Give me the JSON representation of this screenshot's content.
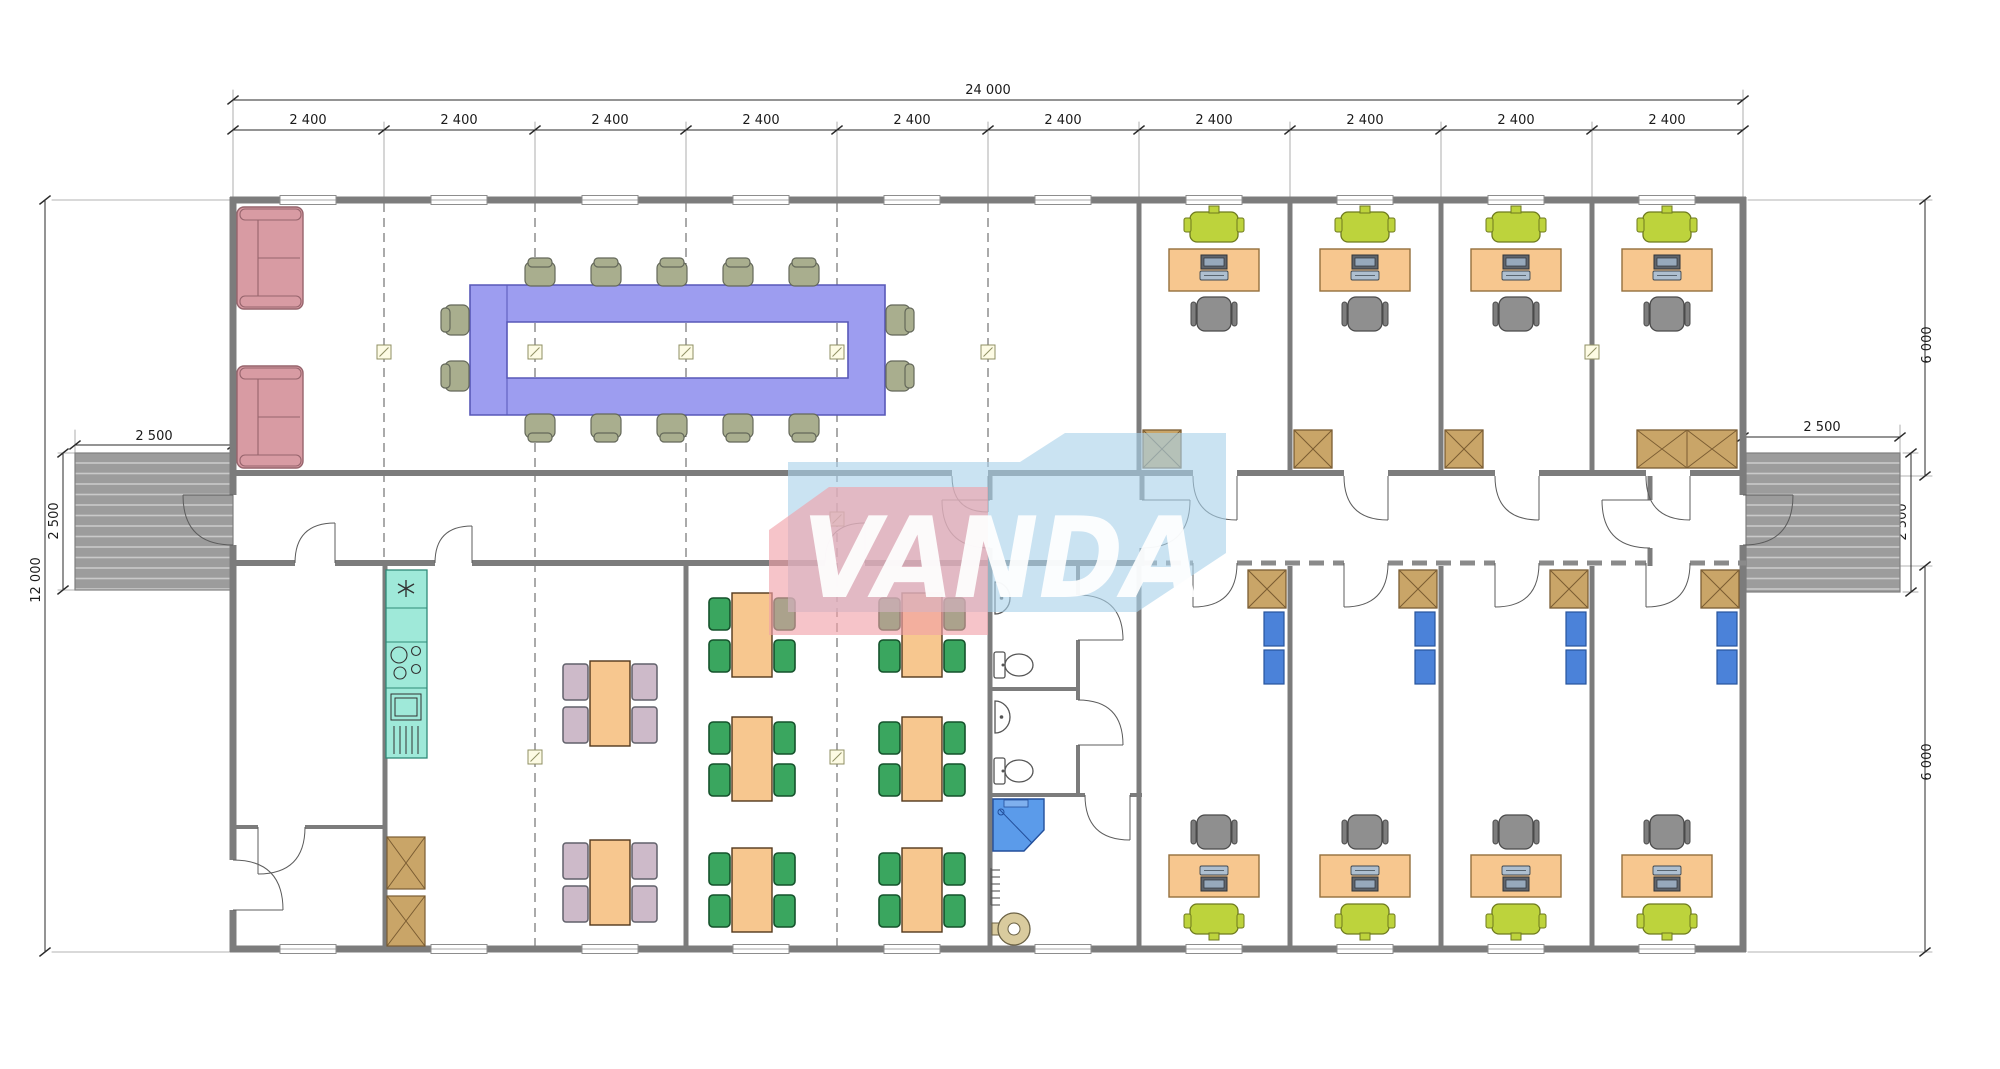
{
  "watermark": {
    "text": "VANDA"
  },
  "dimensions": {
    "total_width": "24 000",
    "module_width": "2 400",
    "total_depth": "12 000",
    "wing_depth_top": "6 000",
    "wing_depth_bottom": "6 000",
    "deck_width": "2 500",
    "deck_depth": "2 500"
  },
  "colors": {
    "wall": "#7c7c7c",
    "wall-light": "#a5a5a5",
    "dim": "#2a2a2a",
    "grid": "#555555",
    "conf-table": "#9d9df0",
    "conf-table-border": "#5858b8",
    "chair-olive": "#a9ae8e",
    "sofa-pink": "#d89ba3",
    "sofa-border": "#96646c",
    "desk-orange": "#f7c78f",
    "desk-border": "#94703d",
    "chair-lime": "#bdd33c",
    "office-chair": "#8f8f8f",
    "cabinet-tan": "#c9a568",
    "cabinet-border": "#7a5c32",
    "locker-blue": "#4b82d9",
    "dining-green": "#3aa65f",
    "dining-pink": "#cdbac9",
    "kitchen-teal": "#9fe9d9",
    "kitchen-border": "#2f8a78",
    "shower-blue": "#5b9bea",
    "boiler-tan": "#d9cb9e",
    "ramp-gray": "#9c9c9c",
    "ramp-stripe": "#c9c9c9",
    "fixture-line": "#555555",
    "wm-pink": "#f0a0a8",
    "wm-blue": "#a9d2ea"
  }
}
